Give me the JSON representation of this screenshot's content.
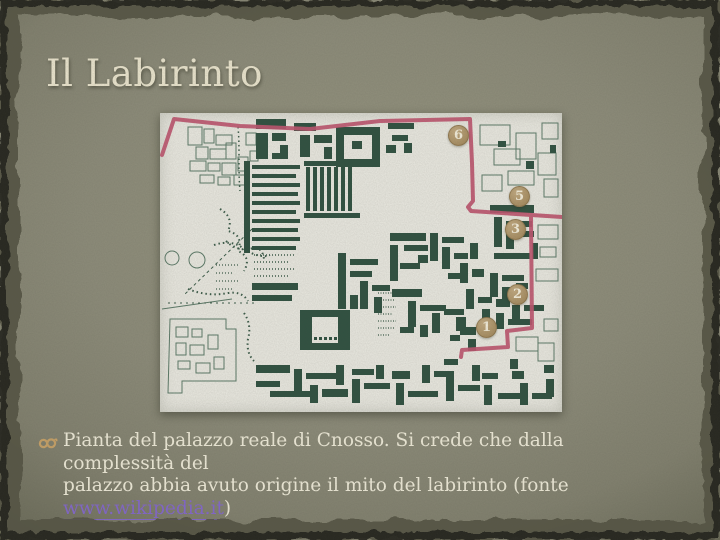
{
  "title": "Il Labirinto",
  "caption": {
    "line1": "Pianta del palazzo reale di Cnosso. Si crede che dalla complessità del",
    "line2": "palazzo abbia avuto origine il mito del labirinto (fonte",
    "link_text": "www.wikipedia.it",
    "suffix": ")"
  },
  "map": {
    "markers": [
      {
        "label": "6"
      },
      {
        "label": "5"
      },
      {
        "label": "3"
      },
      {
        "label": "2"
      },
      {
        "label": "1"
      }
    ]
  },
  "icons": {
    "bullet": "ribbon-bullet-icon"
  },
  "colors": {
    "title_text": "#ece6cf",
    "body_text": "#f0ecda",
    "link": "#8468cc",
    "bullet_glyph": "#c8a268",
    "route_red": "#bf5670",
    "plan_ink_green": "#305141",
    "marker_tan": "#ad9469",
    "slide_background": "#8d8c7a",
    "map_paper": "#eae9e1"
  }
}
